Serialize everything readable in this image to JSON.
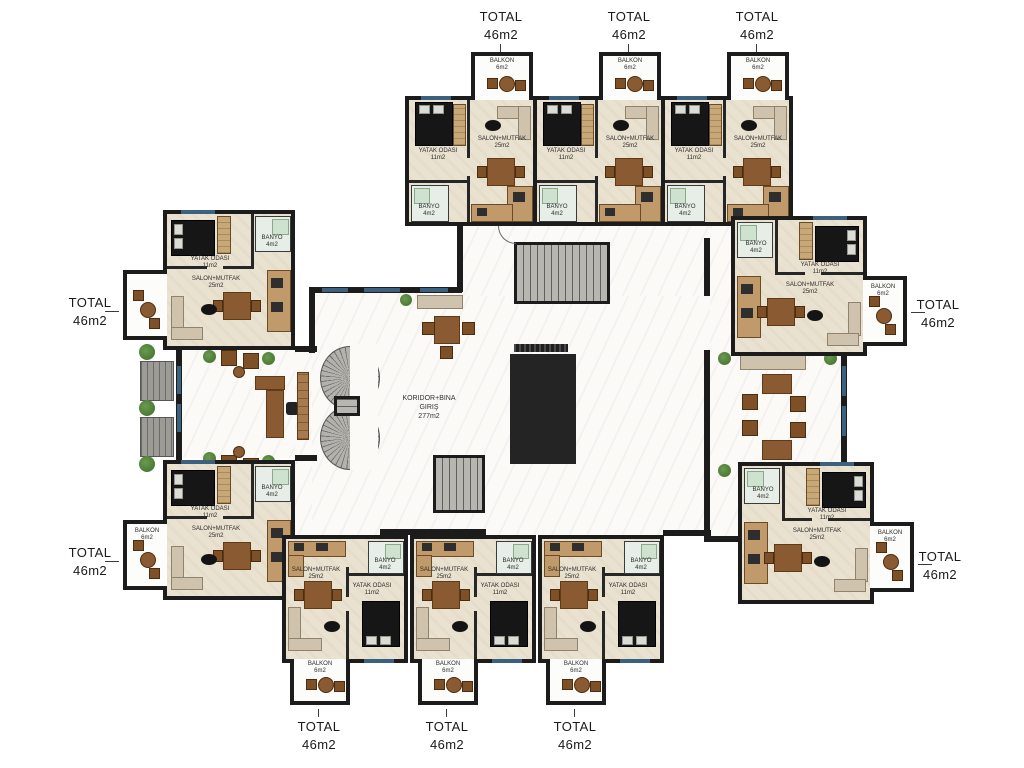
{
  "plan": {
    "corridor": {
      "label_line1": "KORIDOR+BINA",
      "label_line2": "GIRIŞ",
      "label_line3": "277m2"
    },
    "totals": {
      "label": "TOTAL",
      "area": "46m2",
      "count_visible": 10
    },
    "rooms": {
      "salon": {
        "name": "SALON+MUTFAK",
        "area": "25m2"
      },
      "bedroom": {
        "name": "YATAK ODASI",
        "area": "11m2"
      },
      "bathroom": {
        "name": "BANYO",
        "area": "4m2"
      },
      "balcony": {
        "name": "BALKON",
        "area": "6m2"
      }
    },
    "colors": {
      "wall": "#1c1c1c",
      "window": "#3c617f",
      "floor": "#eae2d1",
      "corridor": "#fbfaf7",
      "stair": "#b8b6b1",
      "green": "#4b7a36",
      "wood": "#8a5a33",
      "kitchen": "#c09a6a",
      "sofa": "#cfc3ae",
      "bed": "#161616",
      "lift": "#9c9c9c",
      "tile": "#e7eee7"
    }
  }
}
